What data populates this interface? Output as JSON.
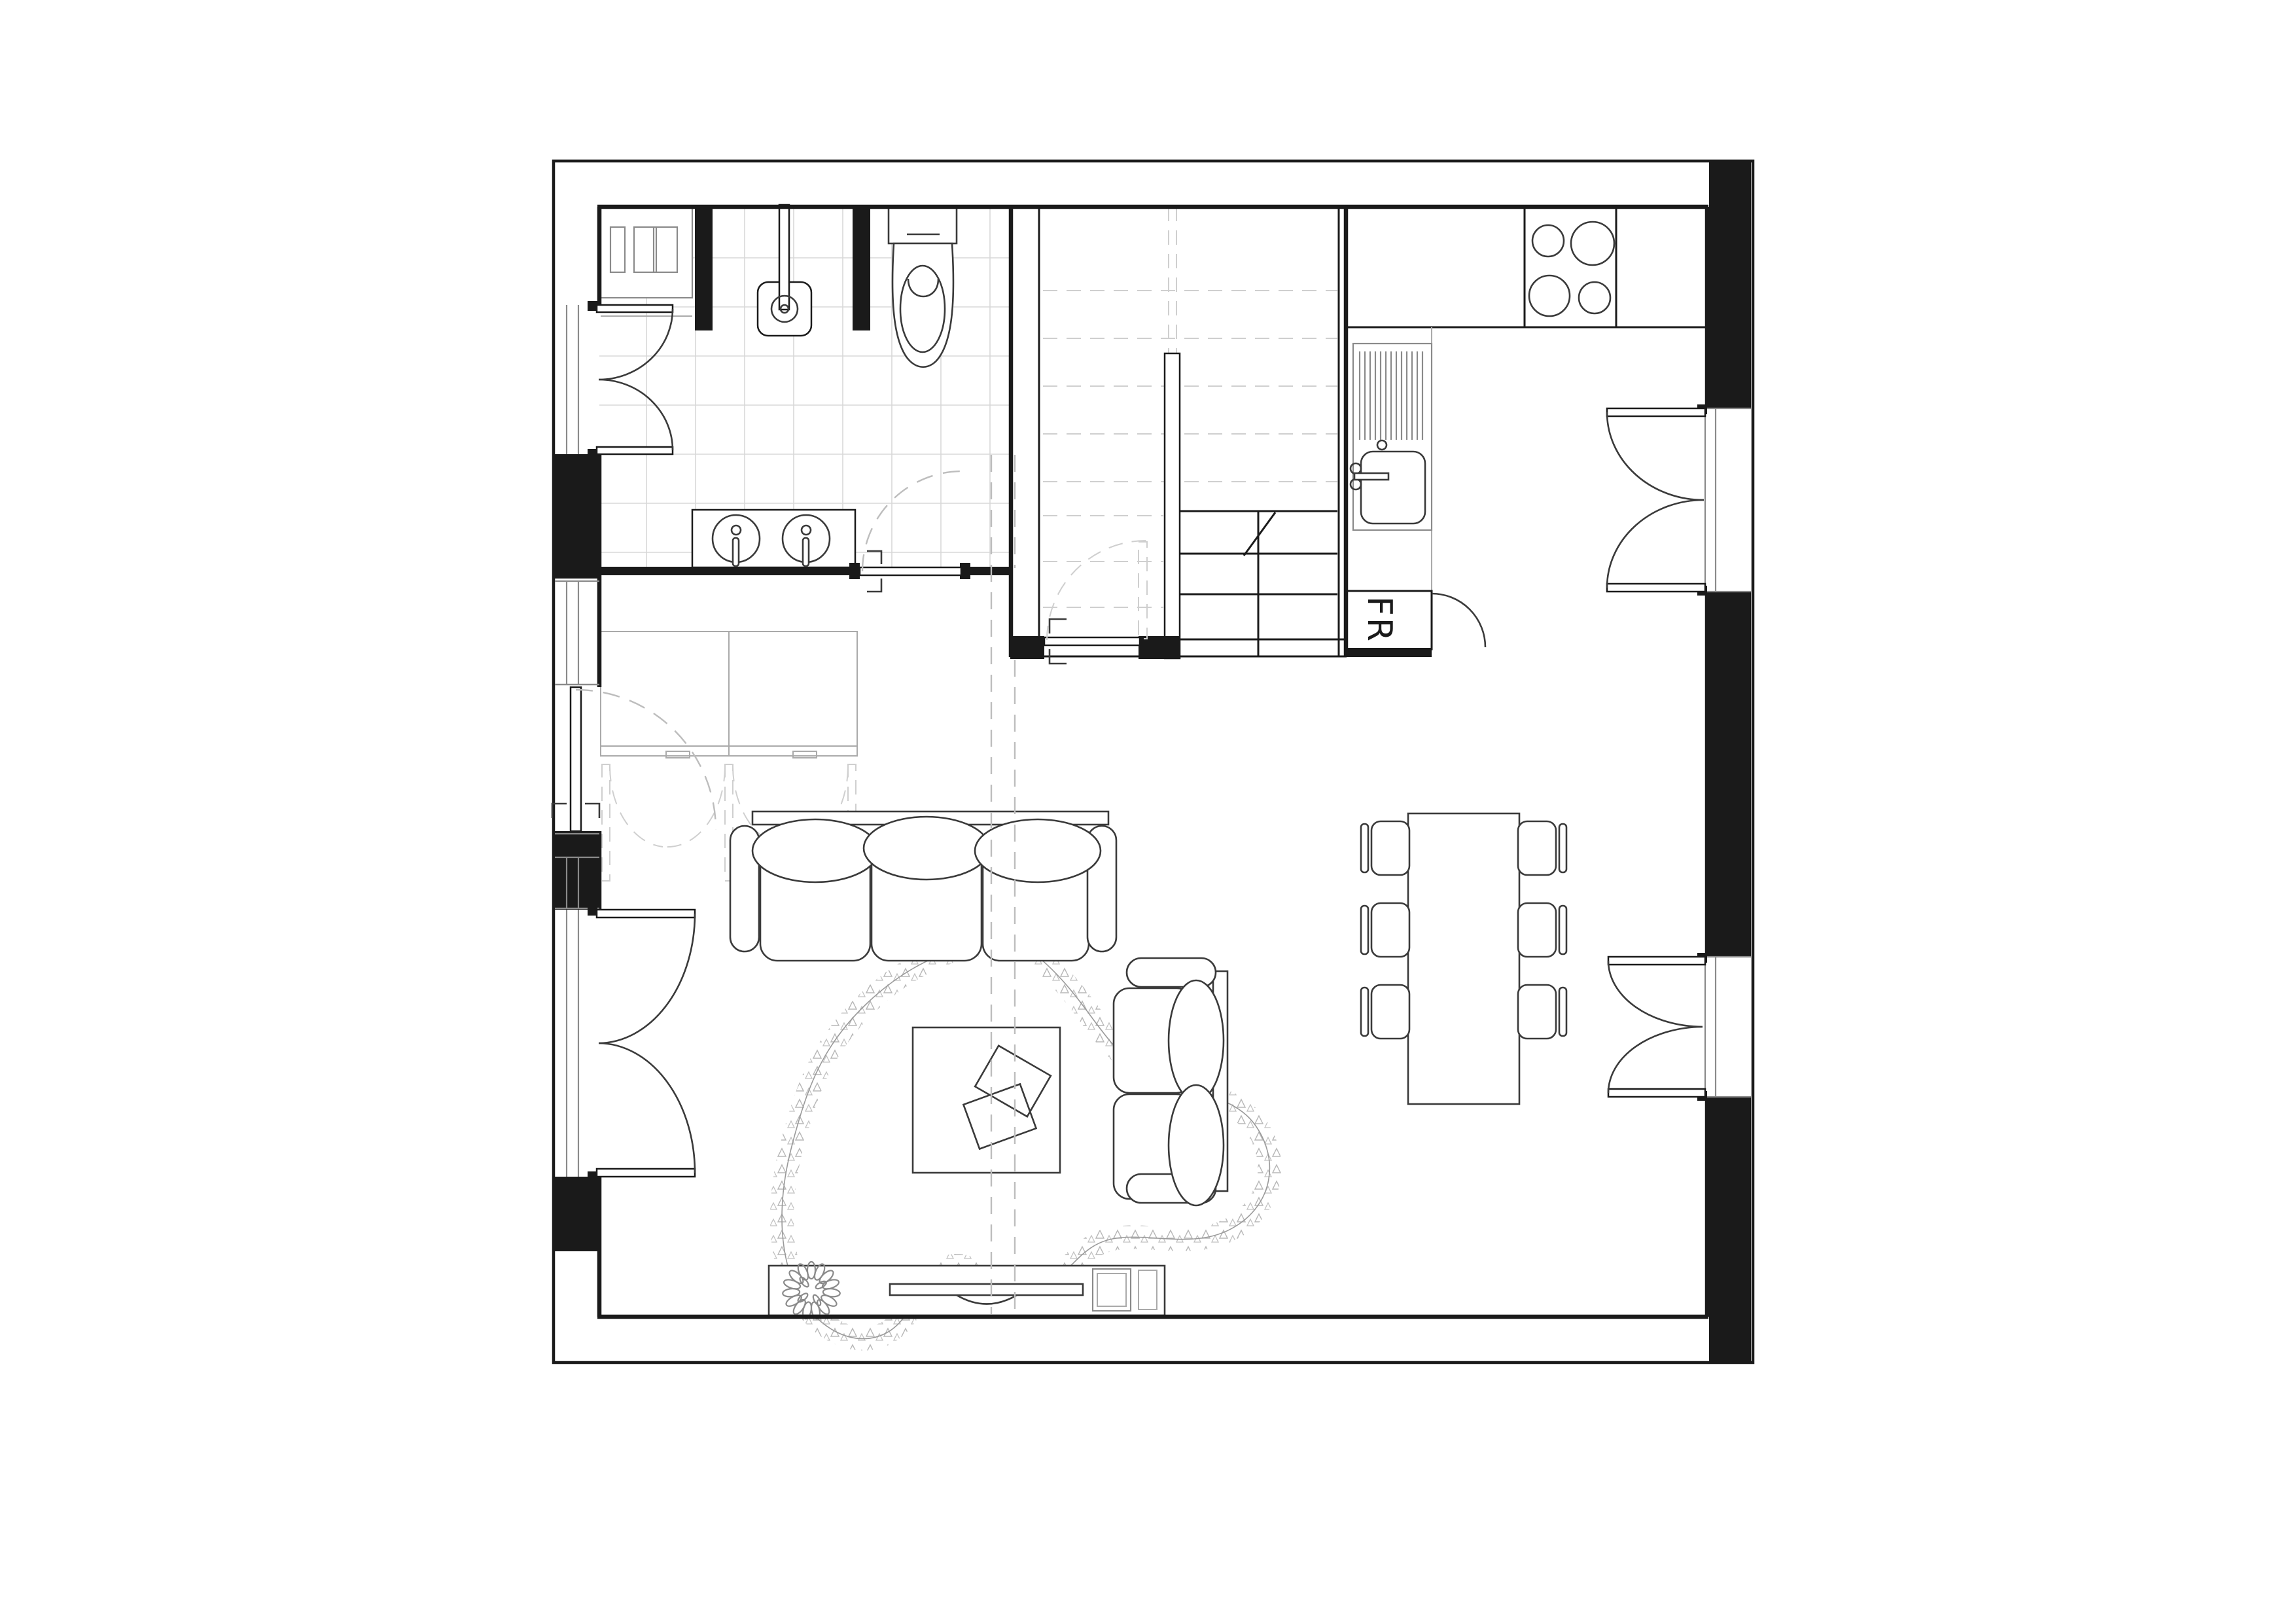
{
  "labels": {
    "fridge": "FR"
  },
  "colors": {
    "bg": "#ffffff",
    "line": "#1a1a1a",
    "mid": "#8a8a8a",
    "light": "#aaaaaa",
    "faint": "#cfcfcf",
    "tile": "#d8d8d8",
    "dash": "#bdbdbd"
  }
}
